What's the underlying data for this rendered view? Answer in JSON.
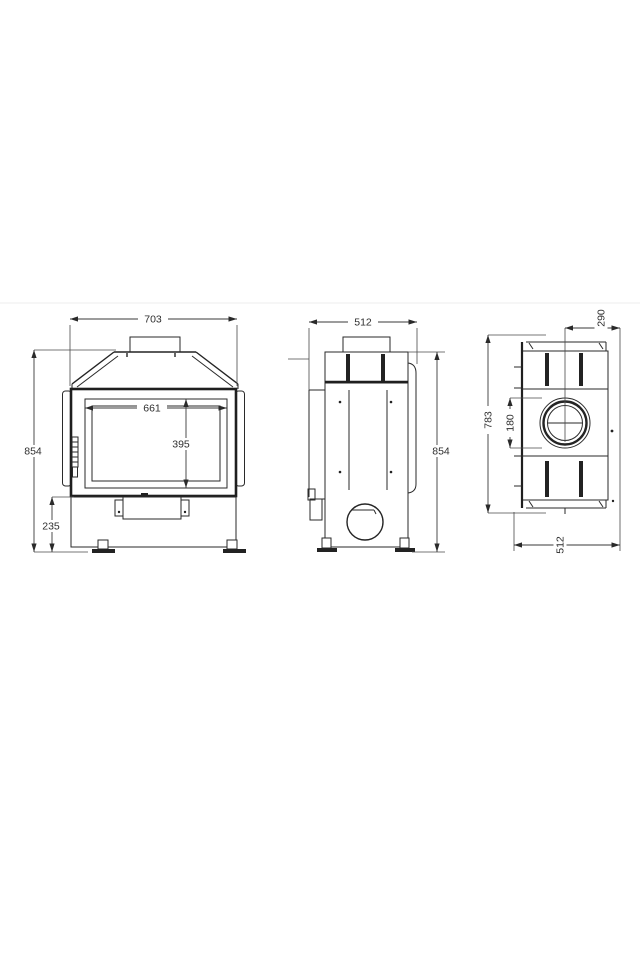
{
  "drawing": {
    "type": "technical-dimension-drawing",
    "subject": "fireplace-insert-three-views",
    "line_color": "#2a2a2a",
    "background": "#ffffff",
    "views": {
      "front": {
        "label": "front-view",
        "dims": {
          "overall_width": "703",
          "glass_width": "661",
          "glass_height": "395",
          "overall_height": "854",
          "base_height": "235"
        }
      },
      "side": {
        "label": "side-view",
        "dims": {
          "depth": "512",
          "overall_height": "854"
        }
      },
      "top": {
        "label": "top-view",
        "dims": {
          "flue_center_to_back": "290",
          "overall_width": "783",
          "flue_diameter": "180",
          "depth": "512"
        }
      }
    }
  }
}
